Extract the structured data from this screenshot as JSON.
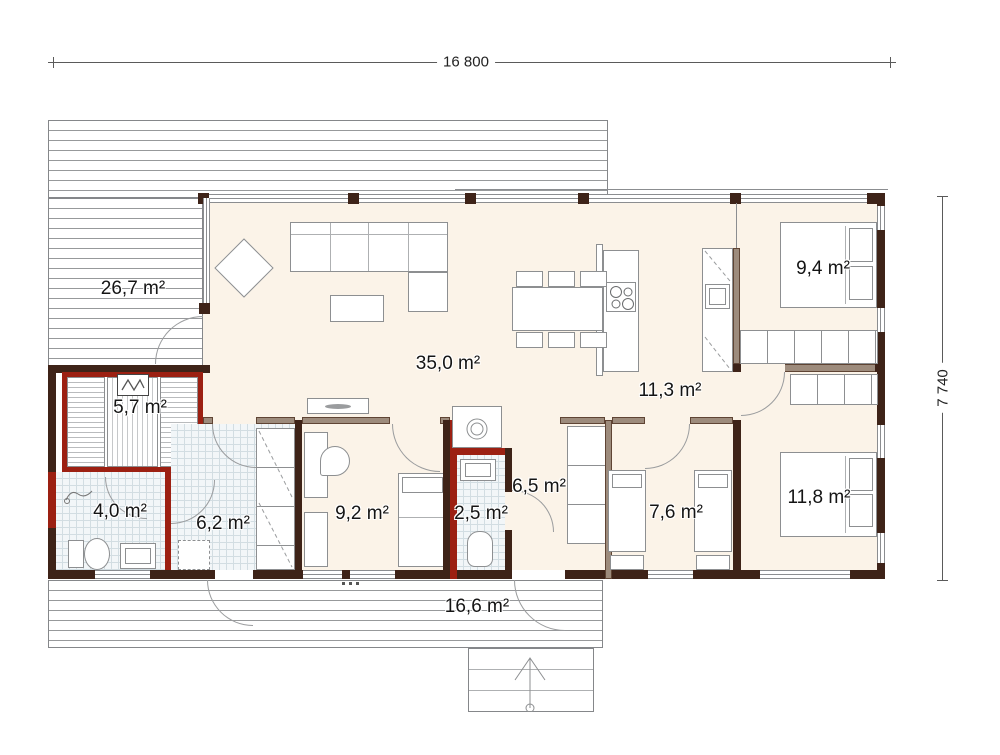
{
  "dimensions": {
    "top": "16 800",
    "right": "7 740"
  },
  "rooms": {
    "deck_left": {
      "label": "26,7 m²"
    },
    "living": {
      "label": "35,0 m²"
    },
    "sauna": {
      "label": "5,7 m²"
    },
    "bathroom": {
      "label": "4,0 m²"
    },
    "utility": {
      "label": "6,2 m²"
    },
    "bedroom_small": {
      "label": "9,2 m²"
    },
    "wc": {
      "label": "2,5 m²"
    },
    "hall_small": {
      "label": "6,5 m²"
    },
    "kids_room": {
      "label": "7,6 m²"
    },
    "hallway": {
      "label": "11,3 m²"
    },
    "bedroom_top": {
      "label": "9,4 m²"
    },
    "bedroom_master": {
      "label": "11,8 m²"
    },
    "deck_bottom": {
      "label": "16,6 m²"
    }
  },
  "colors": {
    "floor_cream": "#fbf3e8",
    "wall_dark": "#3e2318",
    "wall_red": "#9c2012",
    "wall_tan": "#9d8b7c",
    "tile_floor": "#f2f6f8",
    "deck_line": "#97999b"
  }
}
